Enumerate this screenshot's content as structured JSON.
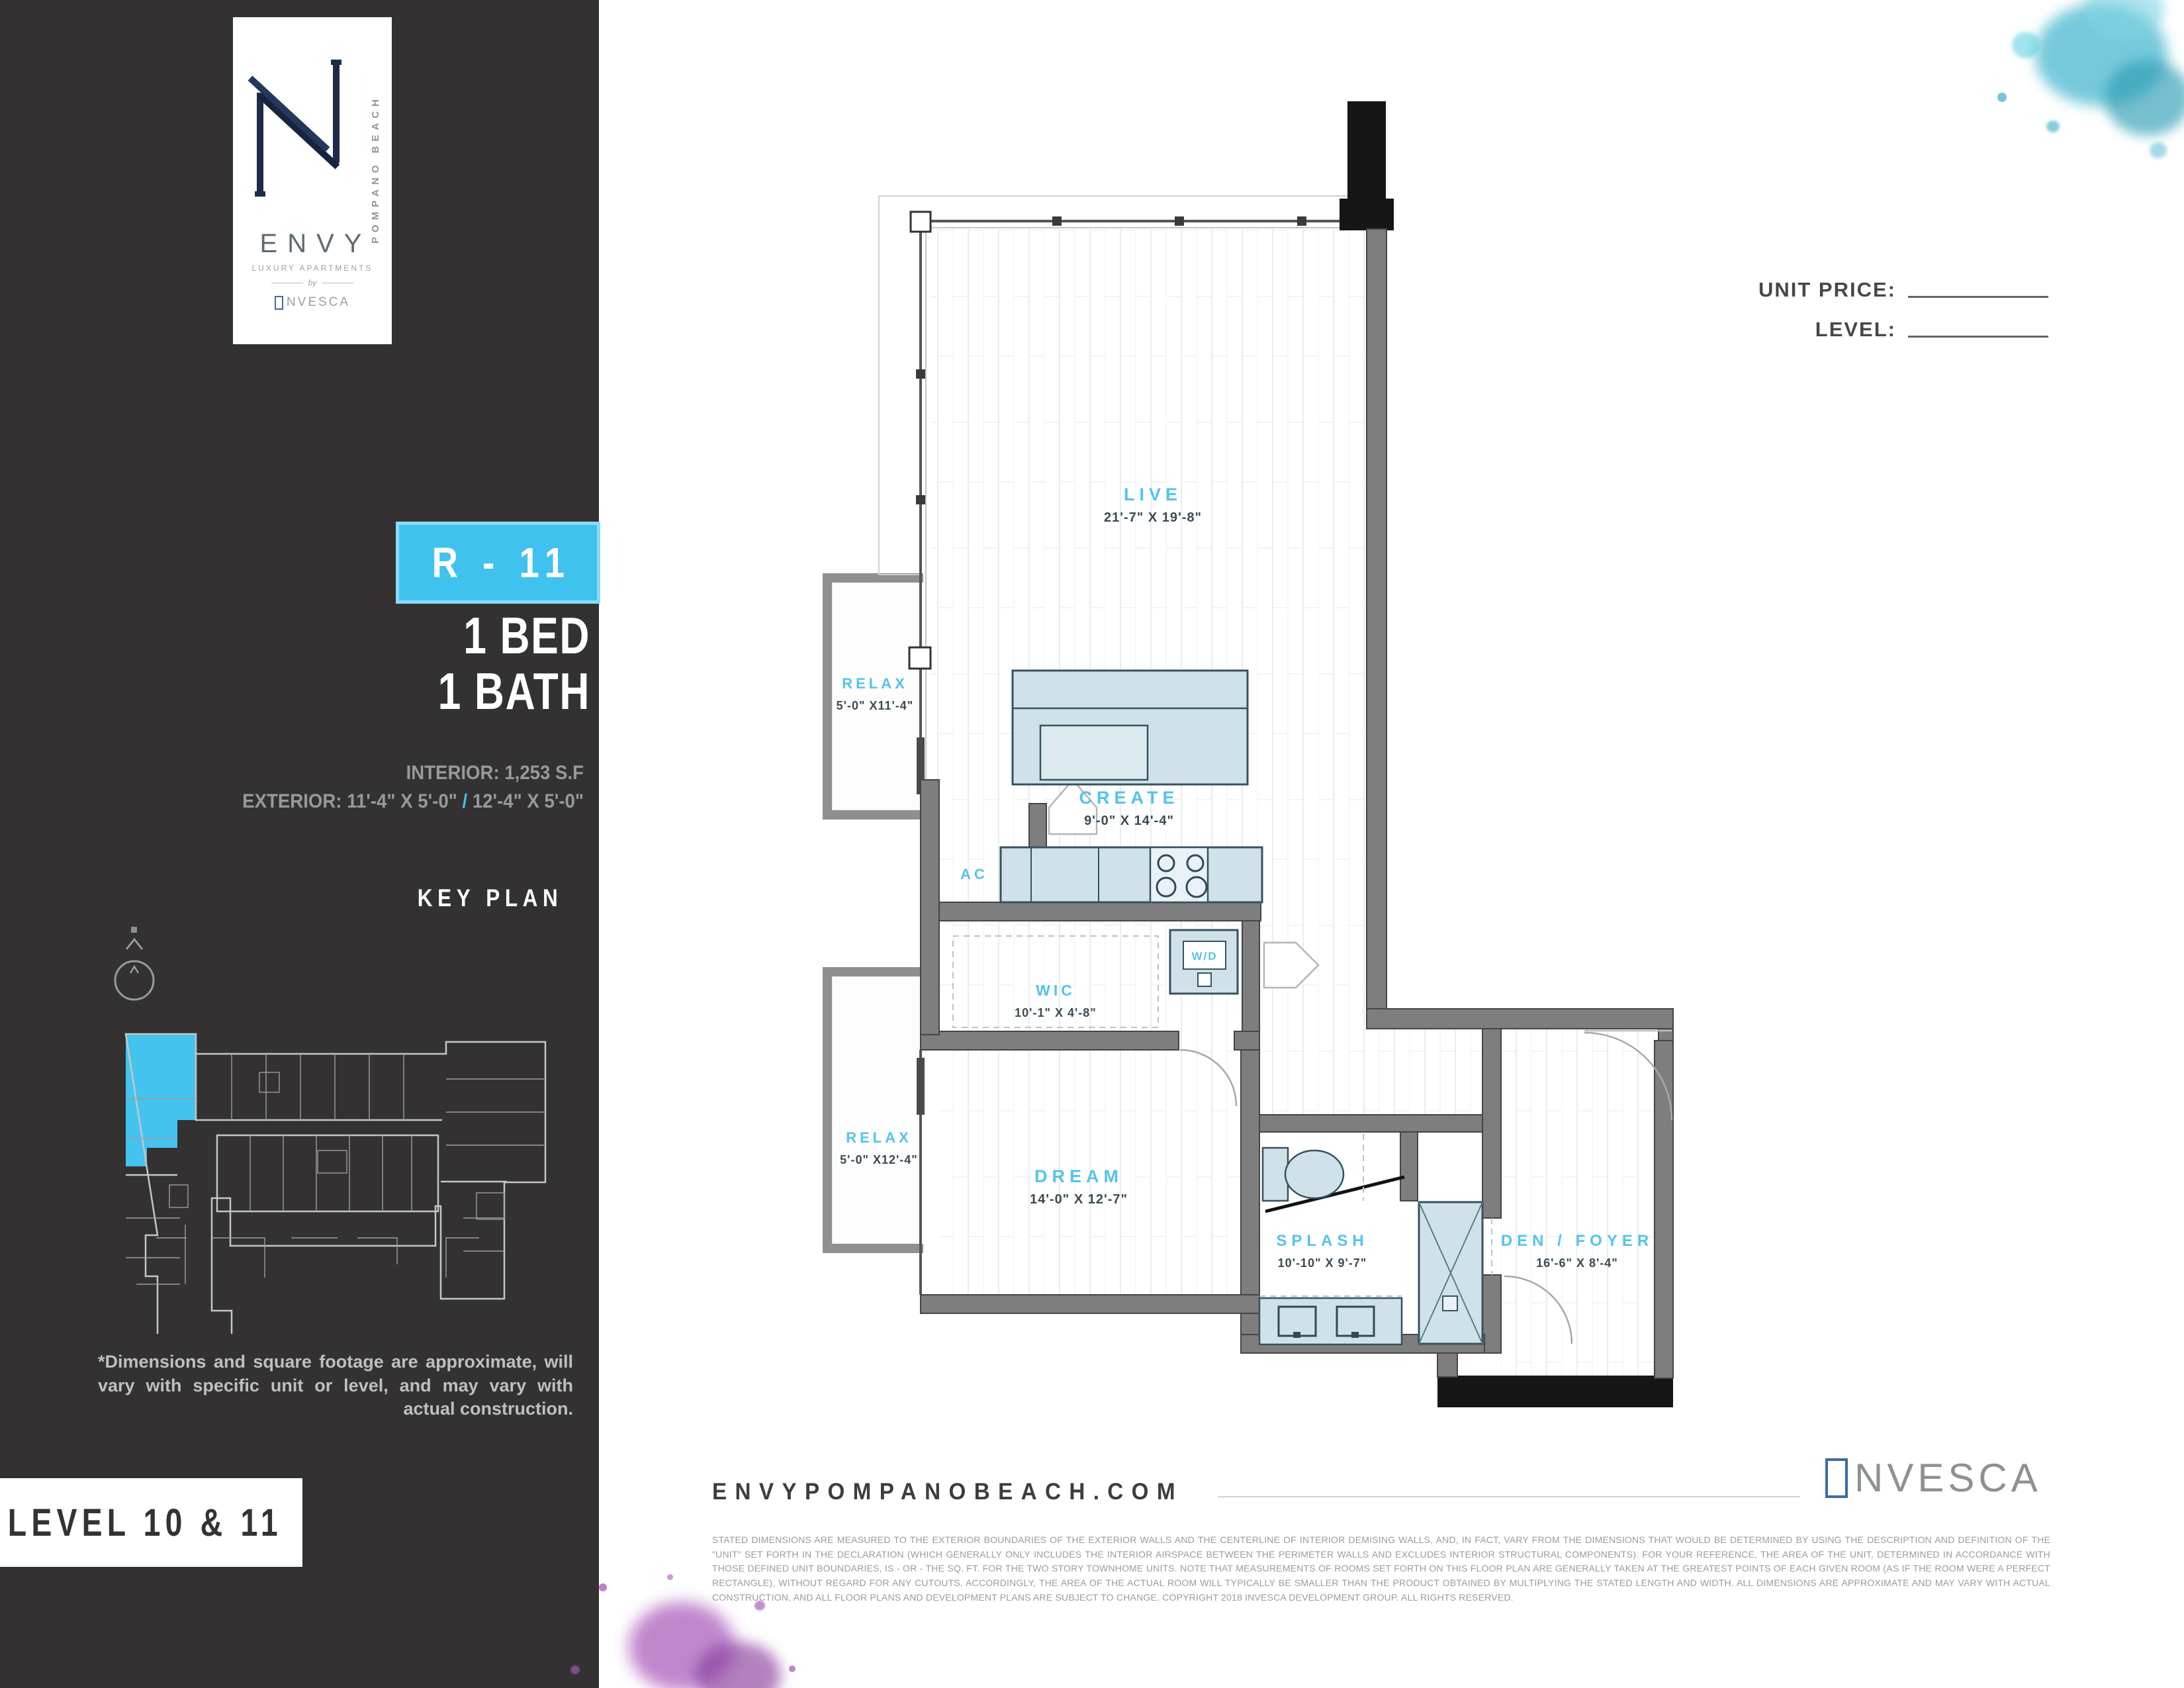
{
  "brand": {
    "vertical_text": "POMPANO BEACH",
    "name": "ENVY",
    "tagline": "LUXURY APARTMENTS",
    "by": "by",
    "developer": "INVESCA",
    "developer_rest": "NVESCA"
  },
  "sidebar": {
    "unit_badge": "R - 11",
    "bed": "1 BED",
    "bath": "1 BATH",
    "interior": "INTERIOR: 1,253 S.F",
    "exterior_label": "EXTERIOR: 11'-4\" X 5'-0\"",
    "exterior_slash": "/",
    "exterior_alt": "12'-4\" X 5'-0\"",
    "key_plan_title": "KEY PLAN",
    "disclaimer": "*Dimensions and square footage are approximate, will vary with specific unit or level, and may vary with actual construction.",
    "level_label": "LEVEL 10 & 11"
  },
  "header": {
    "unit_price_label": "UNIT PRICE:",
    "level_label": "LEVEL:"
  },
  "floorplan": {
    "rooms": [
      {
        "name": "LIVE",
        "dims": "21'-7\" X 19'-8\""
      },
      {
        "name": "RELAX",
        "dims": "5'-0\" X11'-4\""
      },
      {
        "name": "CREATE",
        "dims": "9'-0\" X 14'-4\""
      },
      {
        "name": "AC",
        "dims": ""
      },
      {
        "name": "W/D",
        "dims": ""
      },
      {
        "name": "WIC",
        "dims": "10'-1\" X 4'-8\""
      },
      {
        "name": "RELAX",
        "dims": "5'-0\" X12'-4\""
      },
      {
        "name": "DREAM",
        "dims": "14'-0\" X 12'-7\""
      },
      {
        "name": "SPLASH",
        "dims": "10'-10\" X 9'-7\""
      },
      {
        "name": "DEN / FOYER",
        "dims": "16'-6\" X 8'-4\""
      }
    ]
  },
  "footer": {
    "website": "ENVYPOMPANOBEACH.COM",
    "fine_print": "STATED DIMENSIONS ARE MEASURED TO THE EXTERIOR BOUNDARIES OF THE EXTERIOR WALLS AND THE CENTERLINE OF INTERIOR DEMISING WALLS, AND, IN FACT, VARY FROM THE DIMENSIONS THAT WOULD BE DETERMINED BY USING THE DESCRIPTION AND DEFINITION OF THE \"UNIT\" SET FORTH IN THE DECLARATION (WHICH GENERALLY ONLY INCLUDES THE INTERIOR AIRSPACE BETWEEN THE PERIMETER WALLS AND EXCLUDES INTERIOR STRUCTURAL COMPONENTS). FOR YOUR REFERENCE, THE AREA OF THE UNIT, DETERMINED IN ACCORDANCE WITH THOSE DEFINED UNIT BOUNDARIES, IS - OR - THE SQ. FT. FOR THE TWO STORY TOWNHOME UNITS. NOTE THAT MEASUREMENTS OF ROOMS SET FORTH ON THIS FLOOR PLAN ARE GENERALLY TAKEN AT THE GREATEST POINTS OF EACH GIVEN ROOM (AS IF THE ROOM WERE A PERFECT RECTANGLE), WITHOUT REGARD FOR ANY CUTOUTS. ACCORDINGLY, THE AREA OF THE ACTUAL ROOM WILL TYPICALLY BE SMALLER THAN THE PRODUCT OBTAINED BY MULTIPLYING THE STATED LENGTH AND WIDTH. ALL DIMENSIONS ARE APPROXIMATE AND MAY VARY WITH ACTUAL CONSTRUCTION, AND ALL FLOOR PLANS AND DEVELOPMENT PLANS ARE SUBJECT TO CHANGE. COPYRIGHT 2018 INVESCA DEVELOPMENT GROUP. ALL RIGHTS RESERVED.",
    "developer": "INVESCA",
    "developer_rest": "NVESCA"
  },
  "colors": {
    "accent": "#40c2ef",
    "sidebar_bg": "#343132",
    "fixture_fill": "#cfe2e9",
    "room_label": "#55c3e9"
  }
}
